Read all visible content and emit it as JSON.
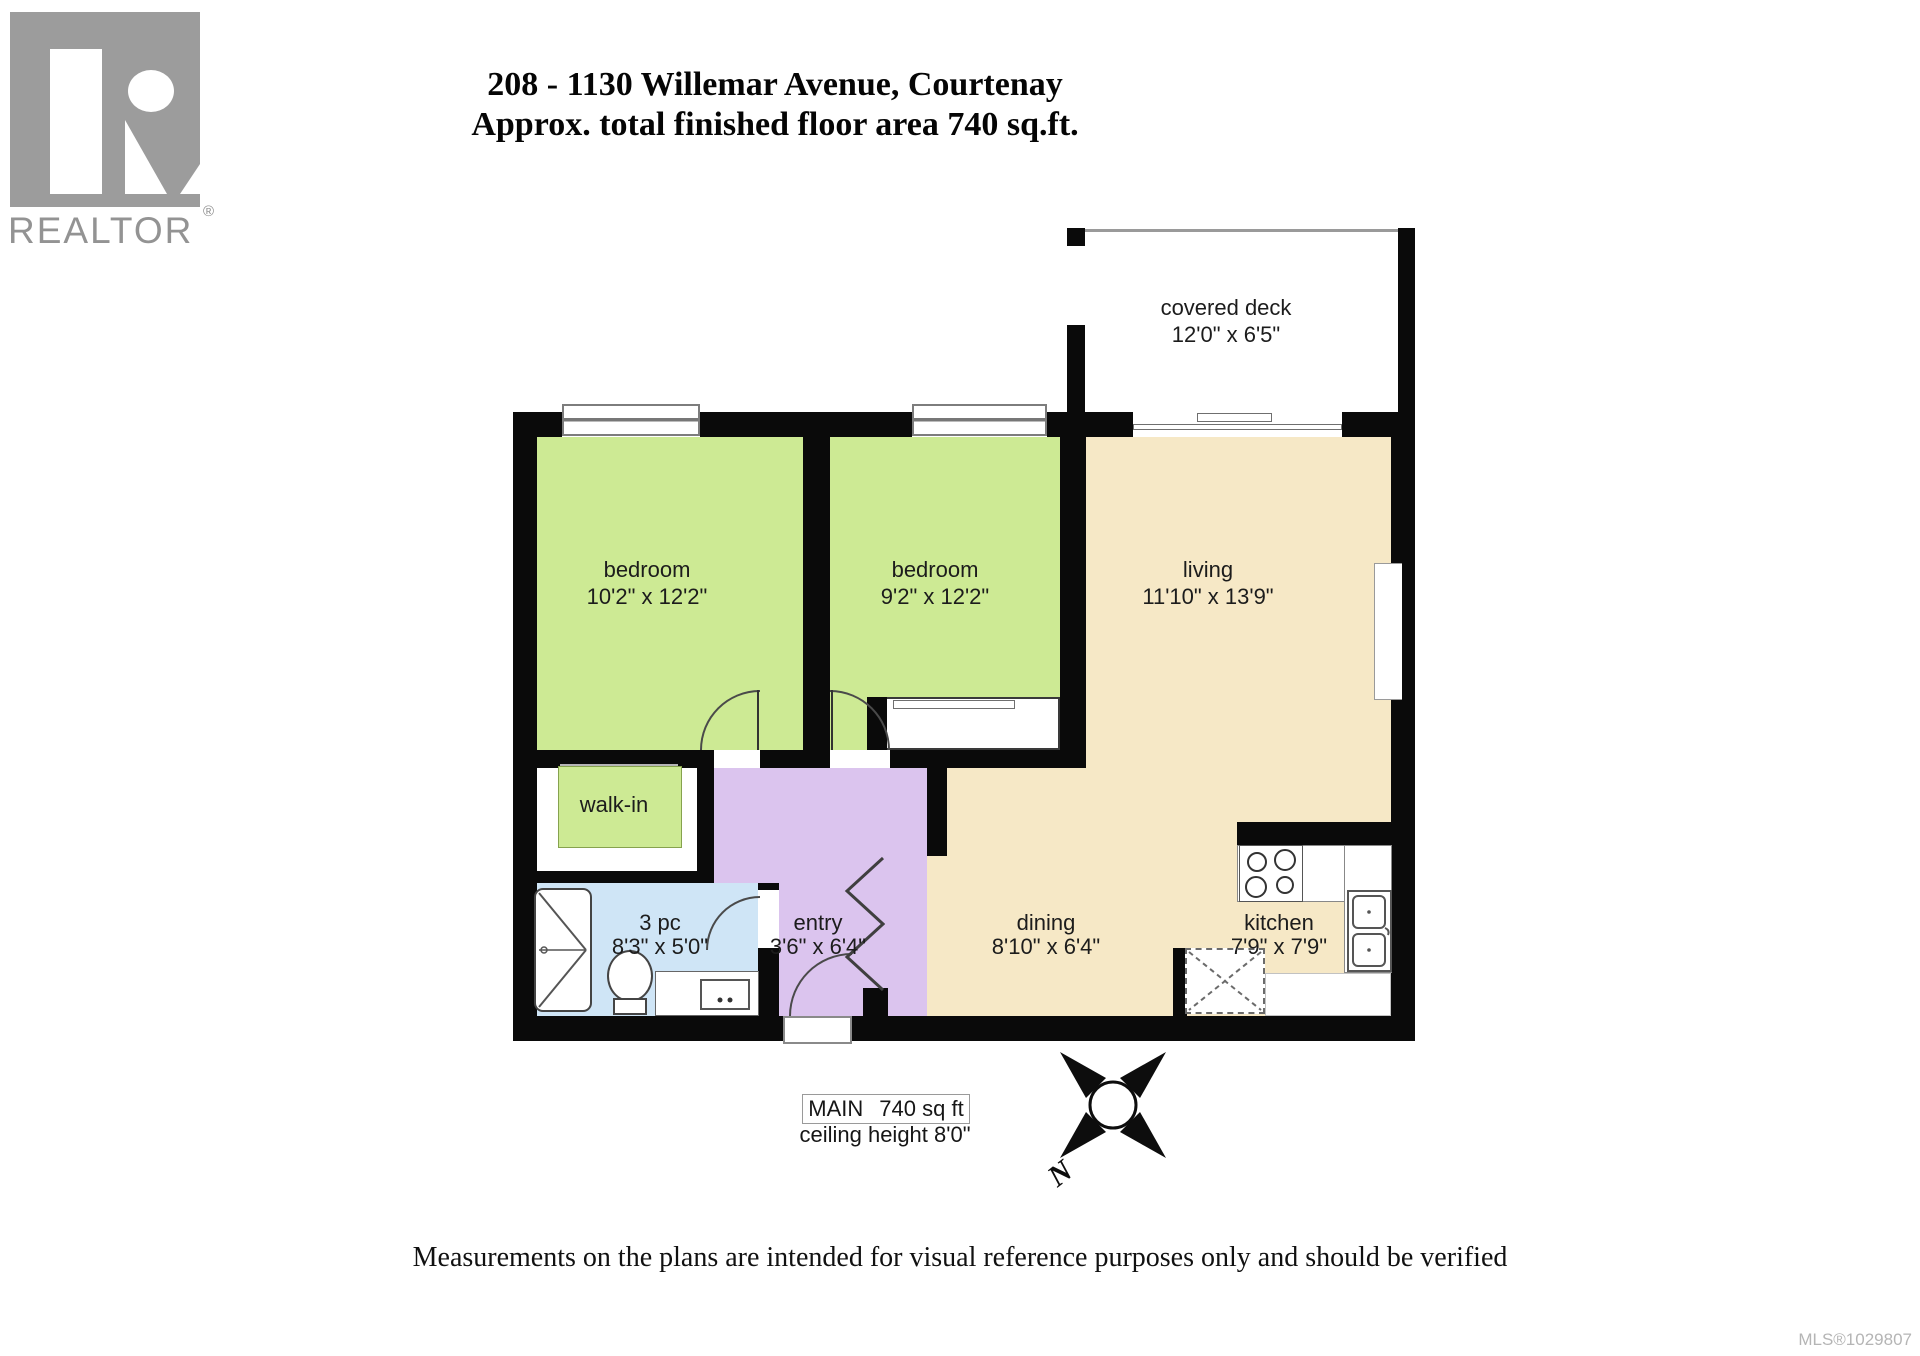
{
  "branding": {
    "logo_text": "REALTOR",
    "registered": "®"
  },
  "title": {
    "line1": "208 - 1130 Willemar Avenue, Courtenay",
    "line2": "Approx. total finished floor area 740 sq.ft."
  },
  "rooms": {
    "covered_deck": {
      "name": "covered deck",
      "dims": "12'0\" x 6'5\""
    },
    "bedroom1": {
      "name": "bedroom",
      "dims": "10'2\" x 12'2\""
    },
    "bedroom2": {
      "name": "bedroom",
      "dims": "9'2\" x 12'2\""
    },
    "living": {
      "name": "living",
      "dims": "11'10\" x 13'9\""
    },
    "walk_in": {
      "name": "walk-in"
    },
    "bath": {
      "name": "3 pc",
      "dims": "8'3\" x 5'0\""
    },
    "entry": {
      "name": "entry",
      "dims": "3'6\" x 6'4\""
    },
    "dining": {
      "name": "dining",
      "dims": "8'10\" x 6'4\""
    },
    "kitchen": {
      "name": "kitchen",
      "dims": "7'9\" x 7'9\""
    }
  },
  "summary": {
    "level": "MAIN",
    "area": "740 sq ft",
    "ceiling": "ceiling height 8'0\""
  },
  "compass": {
    "label": "N"
  },
  "disclaimer": "Measurements on the plans are intended for visual reference purposes only and should be verified",
  "mls": "MLS®1029807",
  "colors": {
    "bedroom_green": "#cdea94",
    "living_tan": "#f6e8c6",
    "entry_purple": "#dbc4ee",
    "bath_blue": "#cfe5f6",
    "wall_black": "#0a0a0a",
    "logo_gray": "#9c9c9c"
  }
}
